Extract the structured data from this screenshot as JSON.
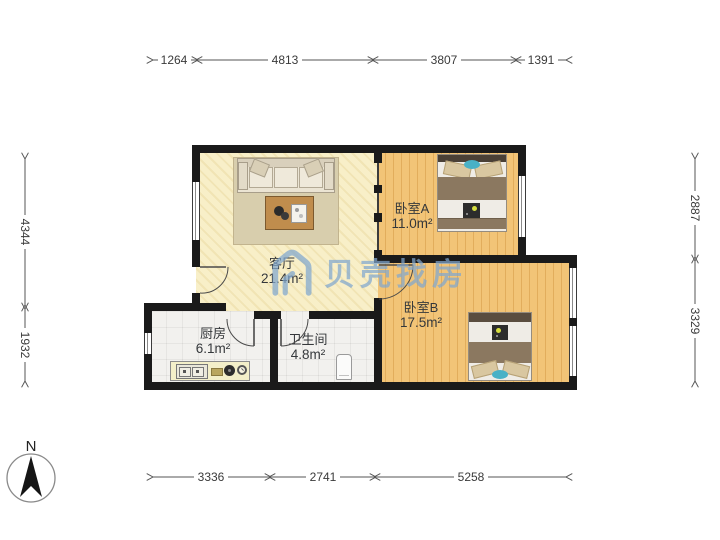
{
  "watermark": {
    "text": "贝壳找房",
    "color": "#80a6ce"
  },
  "compass": {
    "label": "N"
  },
  "rooms": {
    "living": {
      "name": "客厅",
      "area": "21.4m²"
    },
    "bedroom_a": {
      "name": "卧室A",
      "area": "11.0m²"
    },
    "bedroom_b": {
      "name": "卧室B",
      "area": "17.5m²"
    },
    "kitchen": {
      "name": "厨房",
      "area": "6.1m²"
    },
    "bathroom": {
      "name": "卫生间",
      "area": "4.8m²"
    }
  },
  "dimensions": {
    "top": [
      "1264",
      "4813",
      "3807",
      "1391"
    ],
    "bottom": [
      "3336",
      "2741",
      "5258"
    ],
    "left": [
      "4344",
      "1932"
    ],
    "right": [
      "2887",
      "3329"
    ]
  },
  "colors": {
    "wall": "#1a1a1a",
    "living_floor": "#f8efc8",
    "bedroom_floor": "#f2c477",
    "tile_floor": "#f2f1ee",
    "watermark_blue": "#80a6ce",
    "dimension_text": "#3a3a3a",
    "bed_blanket": "#8b7860",
    "accent_teal": "#49b1c6"
  }
}
